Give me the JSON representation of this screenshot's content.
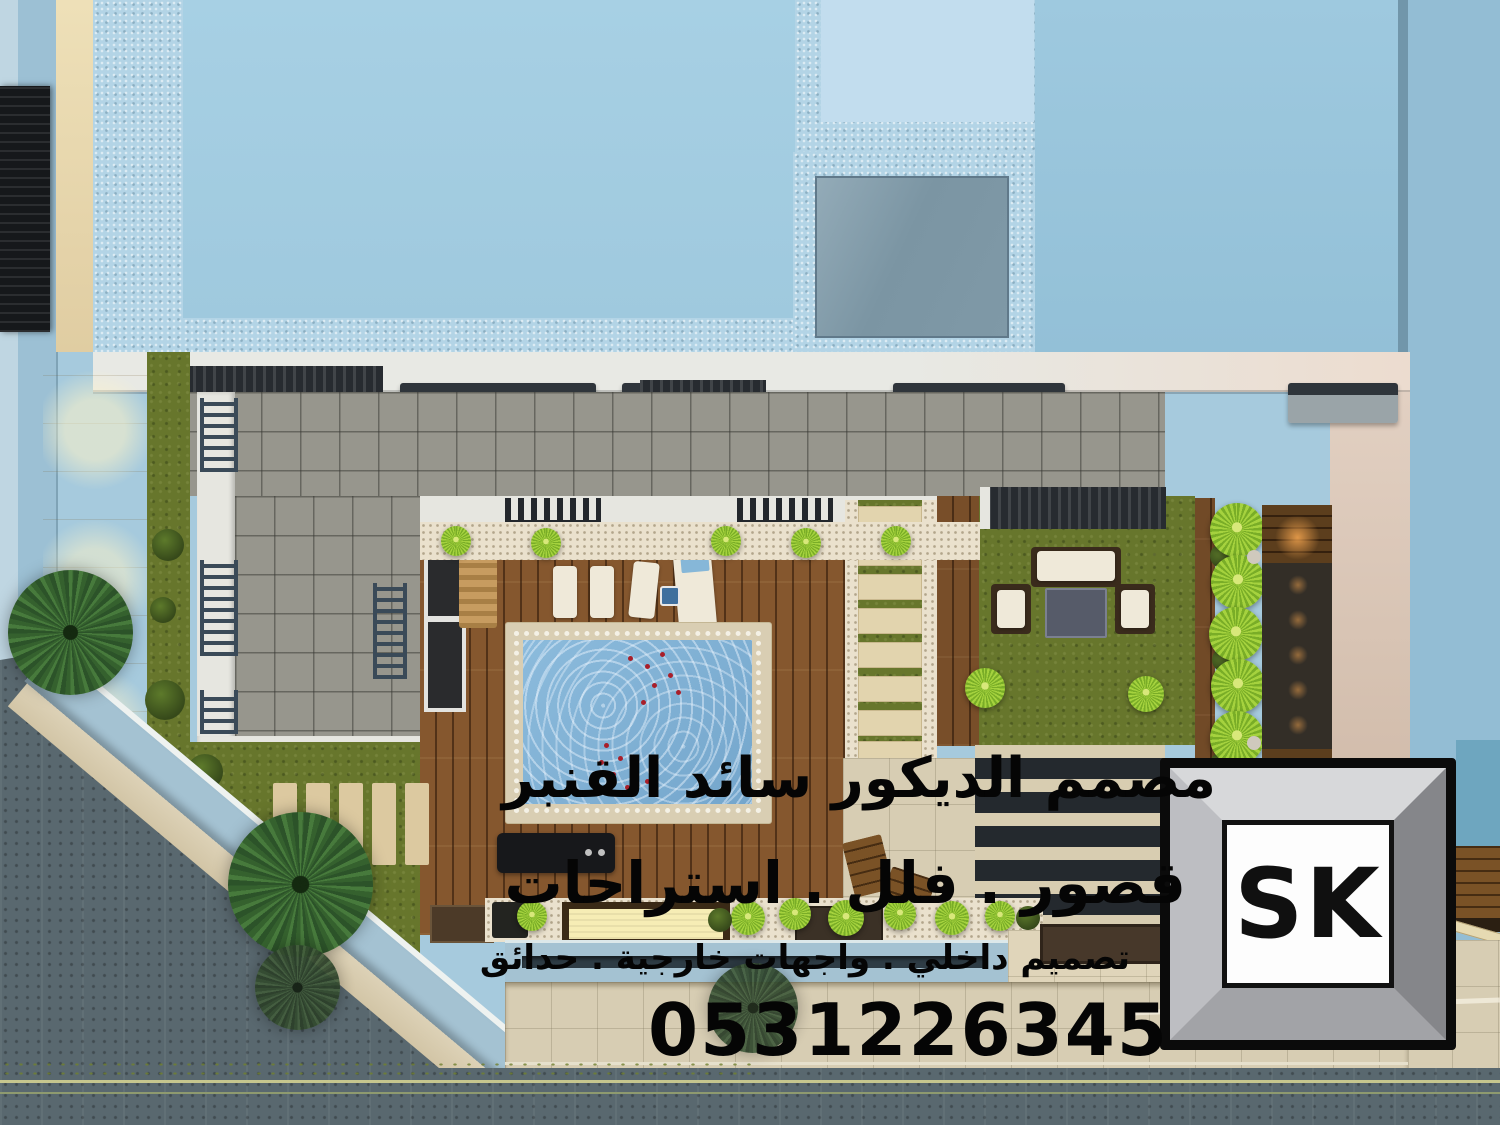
{
  "overlay": {
    "line1": "مصمم الديكور سائد القنبر",
    "line2": "قصور . فلل . استراحات",
    "line3": "تصميم داخلي . واجهات خارجية . حدائق",
    "phone": "0531226345"
  },
  "logo": {
    "text": "SK"
  },
  "palette": {
    "roof_blue": "#a7d0e4",
    "roof_frame_blue": "#b3d4e6",
    "skylight_inner_gray": "#7f99a7",
    "parapet_white": "#e8e9e4",
    "terrace_tile_gray": "#97968d",
    "walkway_cream": "#e8dcb8",
    "grass_green": "#67762c",
    "bright_plant_green": "#a5d23e",
    "deck_wood_brown": "#85572e",
    "pool_water_blue": "#7fb0d6",
    "pool_coping_beige": "#d9ceb3",
    "petal_red": "#a81f2a",
    "marble_stripe_black": "#24292e",
    "pavement_beige": "#d7cdb3",
    "street_gray": "#59686f",
    "lane_line_yellow": "#c6c68e",
    "wall_blue": "#a4c2d2",
    "feature_glow_orange": "#e8a34c",
    "overlay_text_black": "#050505",
    "logo_frame_silver": "#a2a3a7"
  }
}
